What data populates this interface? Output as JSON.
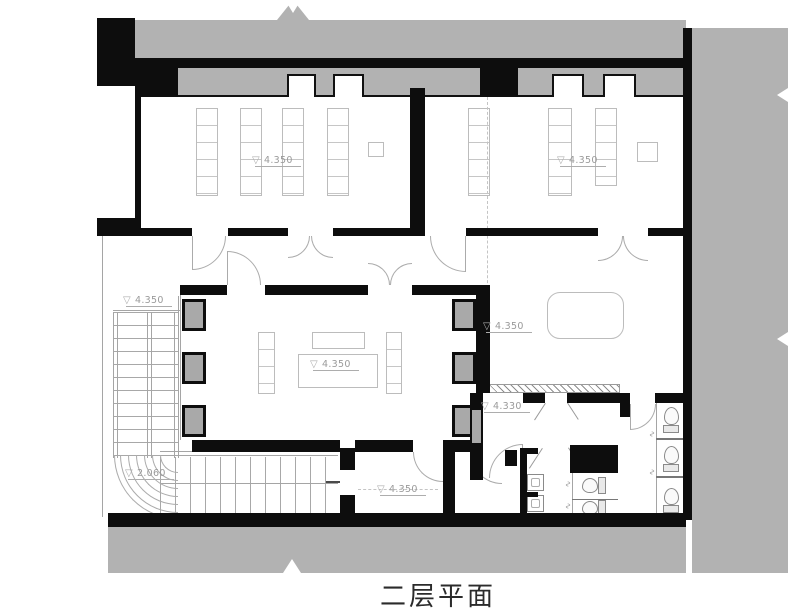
{
  "title": "二层平面",
  "plan": {
    "level_markers": [
      {
        "name": "room-upper-left",
        "value": "4.350",
        "x": 255,
        "y": 148
      },
      {
        "name": "room-upper-right",
        "value": "4.350",
        "x": 560,
        "y": 148
      },
      {
        "name": "hall",
        "value": "4.350",
        "x": 313,
        "y": 352
      },
      {
        "name": "room-middle-right",
        "value": "4.350",
        "x": 486,
        "y": 314
      },
      {
        "name": "stair-landing",
        "value": "4.350",
        "x": 126,
        "y": 288
      },
      {
        "name": "stair-mid-landing",
        "value": "2.060",
        "x": 128,
        "y": 461
      },
      {
        "name": "toilet-vestibule",
        "value": "4.330",
        "x": 484,
        "y": 394
      },
      {
        "name": "room-bottom",
        "value": "4.350",
        "x": 380,
        "y": 477
      }
    ],
    "colors": {
      "surround": "#b2b2b2",
      "wall": "#0d0d0d",
      "thin_line": "#a5a5a5",
      "label_text": "#9a9a9a",
      "title_text": "#2b2b2b"
    }
  }
}
